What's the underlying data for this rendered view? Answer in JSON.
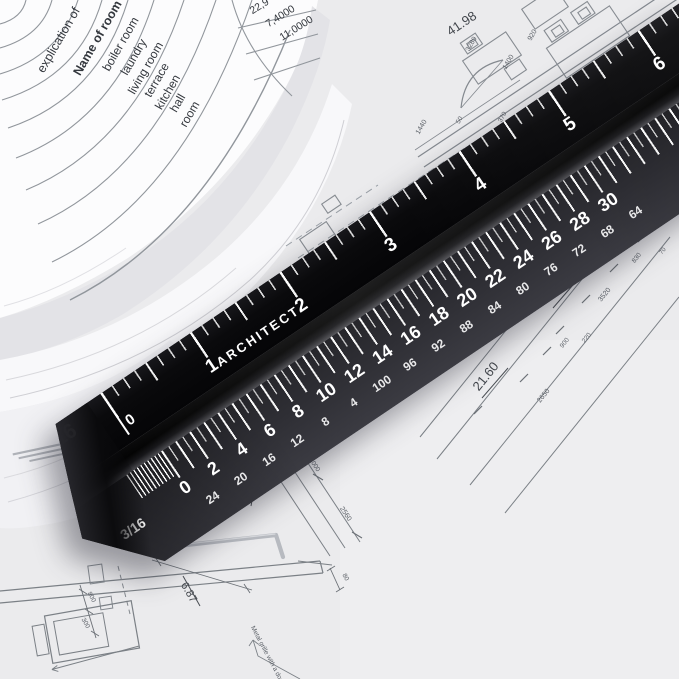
{
  "ruler": {
    "brand": "ARCHITECT",
    "marking_color": "#ffffff",
    "body_color": "#0b0b0d",
    "face_color": "#2f2f35",
    "top_scale": {
      "end_label": "16",
      "zero": "0",
      "inch_numbers": [
        "1",
        "2",
        "3",
        "4",
        "5",
        "6"
      ]
    },
    "front_scale": {
      "end_label": "3/16",
      "large_numbers": [
        "0",
        "2",
        "4",
        "6",
        "8",
        "10",
        "12",
        "14",
        "16",
        "18",
        "20",
        "22",
        "24",
        "26",
        "28",
        "30"
      ],
      "small_numbers": [
        "24",
        "20",
        "16",
        "12",
        "8",
        "4",
        "100",
        "96",
        "92",
        "88",
        "84",
        "80",
        "76",
        "72",
        "68",
        "64"
      ]
    }
  },
  "room_table": {
    "col_title": "explication of",
    "header": "Name of room",
    "rooms": [
      "boiler room",
      "laundry",
      "living room",
      "terrace",
      "kitchen",
      "hall",
      "room"
    ],
    "values": [
      "22,9",
      "7,4000",
      "11,0000"
    ]
  },
  "plan_dims": {
    "d41_98": "41.98",
    "d65_49": "65.49",
    "d21_20": "21.20",
    "d21_60": "21.60",
    "d6_87": "6.87",
    "d5_22": "5.22",
    "d3280": "3280",
    "d1400": "1400",
    "d920": "920",
    "d800_a": "800",
    "d370": "370",
    "d50": "50",
    "d1440": "1440",
    "d1320": "1320",
    "d3520": "3520",
    "d830": "830",
    "d70": "70",
    "d900": "900",
    "d220": "220",
    "d2650": "2650",
    "d1000": "1000",
    "d2560": "2560",
    "d800_b": "800",
    "d300": "300",
    "d80": "80",
    "note": "Metal grille with a door"
  }
}
